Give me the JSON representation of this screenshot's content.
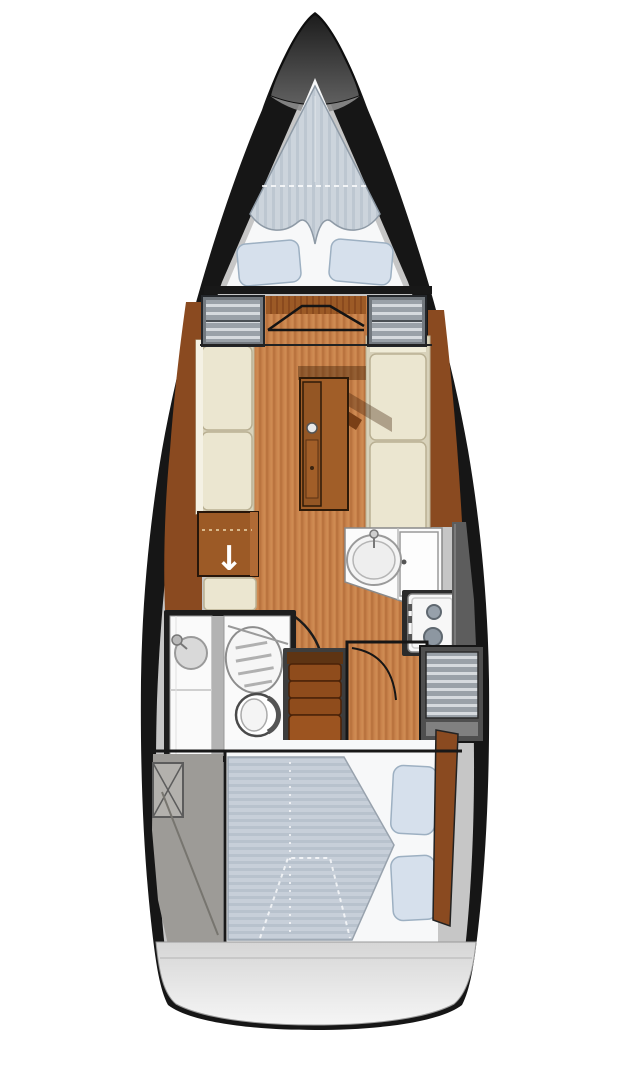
{
  "diagram": {
    "kind": "sailing-yacht-interior-floor-plan",
    "view": "top-down"
  },
  "icons": {
    "down_arrow": "↓"
  },
  "colors": {
    "hull": "#161616",
    "deck": "#c6c6c6",
    "stern_top": "#d6d6d6",
    "stern_bottom": "#f5f5f5",
    "berth_platform": "#f7f8f9",
    "mattress_fore_base": "#ccd4dc",
    "mattress_fore_stripe": "#bdc7d1",
    "mattress_aft_base": "#c7cfd9",
    "mattress_aft_stripe": "#b8c2cd",
    "pillow": "#d6e0ec",
    "pillow_edge": "#9db0c2",
    "wood_floor": "#c9834c",
    "wood_floor_stripe": "#b26c38",
    "wood_dark": "#9c5a26",
    "wood_dark_stripe": "#8a4a1e",
    "wood_outboard": "#8a4a20",
    "settee": "#ebe6d0",
    "settee_back": "#d8d2ba",
    "settee_edge": "#b9b093",
    "table": "#a15e28",
    "table_leaf": "#945624",
    "table_dark": "#7a3f16",
    "steps": "#8f4c1c",
    "steps_light": "#9c5420",
    "steps_landing": "#5e3413",
    "locker_base": "#9aa1a8",
    "locker_stripe": "#d6dade",
    "locker_frame": "#73797f",
    "counter": "#fbfbfb",
    "fixture": "#d9d9d9",
    "burner": "#97a1ab",
    "engine_gray": "#9d9b97",
    "hull_strip": "#5d5d5d",
    "line_dark": "#181818"
  }
}
